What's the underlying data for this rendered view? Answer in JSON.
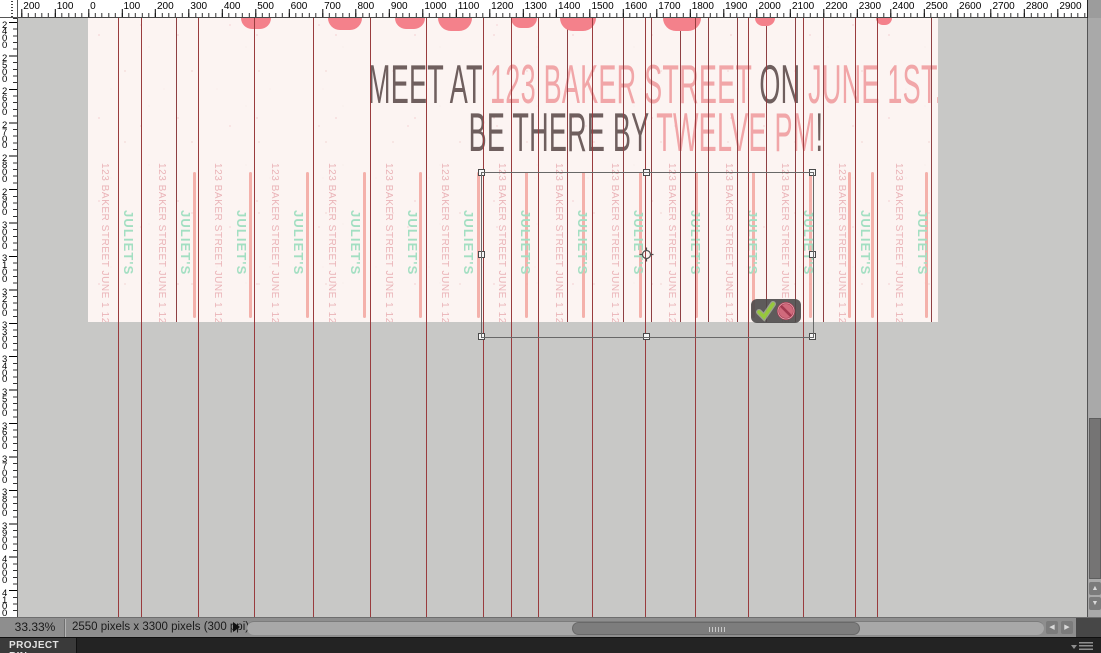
{
  "rulers": {
    "top_labels": [
      "200",
      "100",
      "0",
      "100",
      "200",
      "300",
      "400",
      "500",
      "600",
      "700",
      "800",
      "900",
      "1000",
      "1100",
      "1200",
      "1300",
      "1400",
      "1500",
      "1600",
      "1700",
      "1800",
      "1900",
      "2000",
      "2100",
      "2200",
      "2300",
      "2400",
      "2500",
      "2600",
      "2700",
      "2800",
      "2900"
    ],
    "left_labels": [
      "2400",
      "2500",
      "2600",
      "2700",
      "2800",
      "2900",
      "3000",
      "3100",
      "3200",
      "3300",
      "3400",
      "3500",
      "3600",
      "3700",
      "3800",
      "3900",
      "4000",
      "4100"
    ]
  },
  "flyer": {
    "title_line1": [
      {
        "text": "MEET AT ",
        "tone": "dark"
      },
      {
        "text": "123 BAKER STREET ",
        "tone": "pink"
      },
      {
        "text": "ON ",
        "tone": "dark"
      },
      {
        "text": "JUNE 1ST.",
        "tone": "pink"
      }
    ],
    "title_line2": [
      {
        "text": "BE THERE BY ",
        "tone": "dark"
      },
      {
        "text": "TWELVE PM",
        "tone": "pink"
      },
      {
        "text": "!",
        "tone": "dark"
      }
    ],
    "strip_address": "123 BAKER STREET JUNE 1 12 PM",
    "strip_name": "JULIET'S",
    "strip_count": 15,
    "scallops": [
      {
        "x": 256,
        "w": 30,
        "h": 11
      },
      {
        "x": 345,
        "w": 34,
        "h": 12
      },
      {
        "x": 410,
        "w": 30,
        "h": 11
      },
      {
        "x": 455,
        "w": 34,
        "h": 13
      },
      {
        "x": 524,
        "w": 26,
        "h": 10
      },
      {
        "x": 578,
        "w": 36,
        "h": 13
      },
      {
        "x": 682,
        "w": 38,
        "h": 13
      },
      {
        "x": 765,
        "w": 20,
        "h": 8
      },
      {
        "x": 884,
        "w": 16,
        "h": 7
      }
    ]
  },
  "editor": {
    "guides_full": [
      118,
      141,
      198,
      254,
      313,
      370,
      426,
      483,
      511,
      538,
      592,
      645,
      695,
      748,
      803,
      855,
      877
    ],
    "strip_lines_canvas": [
      176,
      567,
      623,
      651,
      680,
      708,
      737,
      766,
      795,
      823,
      931
    ],
    "accent_lines_canvas": [
      196,
      252,
      309,
      366,
      422,
      480,
      528,
      585,
      642,
      698,
      755,
      812,
      851,
      874,
      928
    ],
    "transform_controls": {
      "commit_icon": "check",
      "cancel_icon": "no-symbol"
    }
  },
  "status_bar": {
    "zoom_level": "33.33%",
    "document_size": "2550 pixels x 3300 pixels (300 ppi)"
  },
  "project_bin": {
    "label": "PROJECT BIN"
  },
  "colors": {
    "guide_red": "#993c3e",
    "strip_line_red": "#8e4043",
    "strip_text_pink": "#eab4b8",
    "strip_text_green": "#a3dfc2",
    "title_dark": "#6f5f5e",
    "title_pink": "#f1a6a8",
    "scallop_coral": "#f4818b",
    "canvas_bg": "#fcf4f2",
    "commit_green": "#96c83c",
    "cancel_red": "#d06a7c"
  }
}
